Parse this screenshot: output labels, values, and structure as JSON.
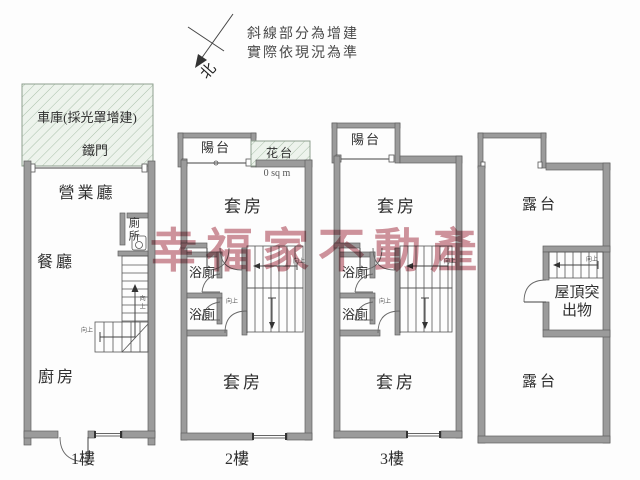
{
  "annotation": {
    "line1": "斜線部分為增建",
    "line2": "實際依現況為準",
    "north": "北"
  },
  "watermark": {
    "text": "幸福家不動產",
    "color": "#c9848e"
  },
  "floor1": {
    "garage": "車庫(採光罩增建)",
    "gate": "鐵門",
    "sales_hall": "營業廳",
    "toilet": "廁所",
    "dining": "餐廳",
    "kitchen": "廚房",
    "up": "向上",
    "label": "1樓"
  },
  "floor2": {
    "balcony": "陽台",
    "flower_bed": "花台",
    "area": "0 sq m",
    "suite_upper": "套房",
    "bath_upper": "浴廁",
    "bath_lower": "浴廁",
    "suite_lower": "套房",
    "up": "向上",
    "label": "2樓"
  },
  "floor3": {
    "balcony": "陽台",
    "suite_upper": "套房",
    "bath_upper": "浴廁",
    "bath_lower": "浴廁",
    "suite_lower": "套房",
    "up": "向上",
    "label": "3樓"
  },
  "roof": {
    "terrace_upper": "露台",
    "penthouse": "屋頂突出物",
    "terrace_lower": "露台",
    "up": "向上"
  },
  "colors": {
    "wall": "#9b9b9b",
    "hatch_bg": "#edf3ec",
    "hatch_line": "#a9c0a9",
    "watermark": "#c9848e"
  }
}
